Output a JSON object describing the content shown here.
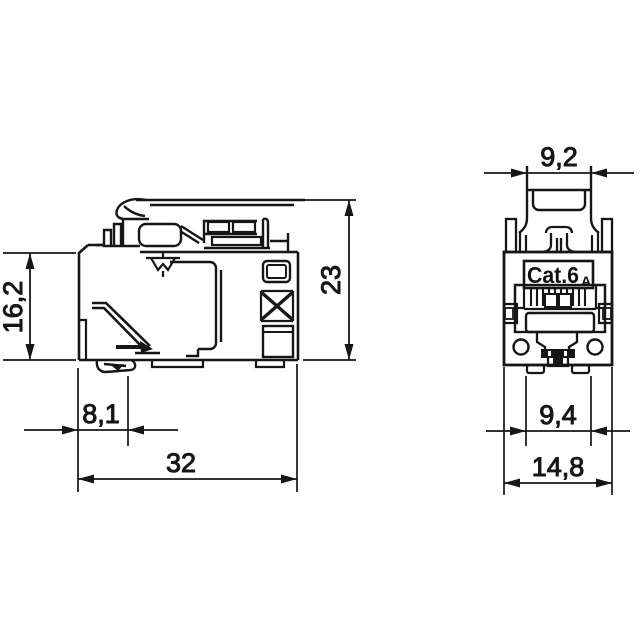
{
  "drawing": {
    "type": "technical-dimension-drawing",
    "background_color": "#ffffff",
    "line_color": "#161616"
  },
  "side_view": {
    "dimensions": {
      "front_height": "16,2",
      "latch_depth": "8,1",
      "total_depth": "32",
      "total_height": "23"
    }
  },
  "front_view": {
    "label": "Cat.6",
    "label_subscript": "A",
    "dimensions": {
      "latch_width": "9,2",
      "foot_width": "9,4",
      "total_width": "14,8"
    }
  }
}
